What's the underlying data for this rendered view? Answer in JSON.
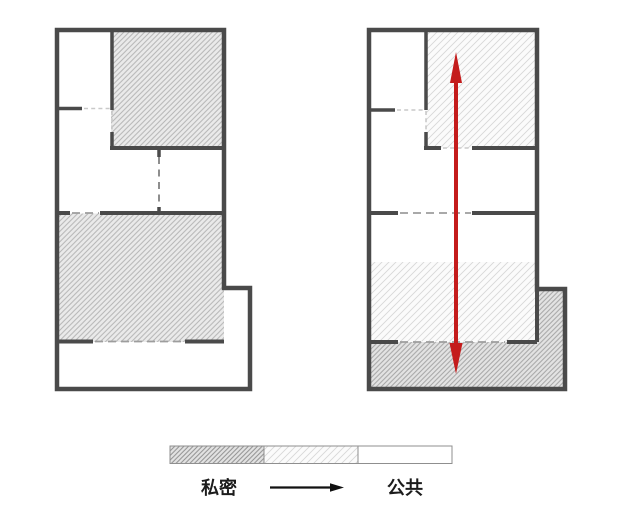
{
  "legend": {
    "private_label": "私密",
    "public_label": "公共"
  },
  "colors": {
    "wall": "#4a4a4a",
    "accent-red": "#c41c1c",
    "dash": "#9d9d9d",
    "dash-light": "#c9c9c9",
    "legend-border": "#8f8f8f",
    "text": "#1c1c1c",
    "page-bg": "#ffffff",
    "hatch-dense-bg": "#e2e2e2",
    "hatch-dense-line": "#909090",
    "hatch-medium-bg": "#eaeaea",
    "hatch-medium-line": "#b5b5b5",
    "hatch-mediumplus-bg": "#e3e3e3",
    "hatch-mediumplus-line": "#a5a5a5",
    "hatch-light-bg": "#fbfbfb",
    "hatch-light-line": "#d8d8d8"
  }
}
